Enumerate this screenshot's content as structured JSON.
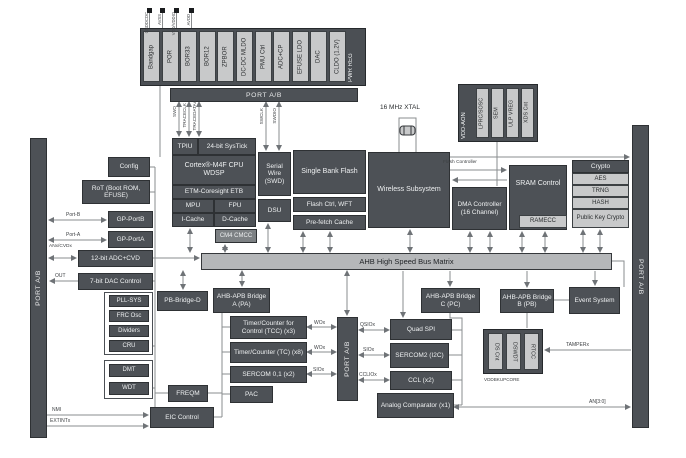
{
  "power": {
    "label": "PWR REG",
    "pins": [
      "GNDDCDC",
      "AVSS",
      "VDD/VDDIO",
      "AVDD"
    ],
    "cells": [
      "Bandgap",
      "POR",
      "BOR33",
      "BOR12",
      "ZPBOR",
      "DC-DC MLDO",
      "PMU Ctrl",
      "ADC+CP",
      "EFUSE LDO",
      "DAC",
      "CLDO (1.2V)"
    ]
  },
  "ports": {
    "top": "PORT A/B",
    "left": "PORT A/B",
    "mid": "PORT A/B",
    "right": "PORT A/B"
  },
  "cpu": {
    "tpiu": "TPIU",
    "systick": "24-bit SysTick",
    "core": "Cortex®-M4F CPU WDSP",
    "etb": "ETM-Coresight ETB",
    "mpu": "MPU",
    "fpu": "FPU",
    "icache": "I-Cache",
    "dcache": "D-Cache",
    "cmcc": "CM4 CMCC"
  },
  "debug": {
    "swd": "Serial Wire (SWD)",
    "dsu": "DSU"
  },
  "flash": {
    "bank": "Single Bank Flash",
    "ctrl": "Flash Ctrl, WFT",
    "prefetch": "Pre-fetch Cache",
    "controller_label": "Flash Controller"
  },
  "wireless": {
    "name": "Wireless Subsystem",
    "xtal_label": "16 MHz XTAL"
  },
  "aon": {
    "label": "VDD-AON",
    "cells": [
      "LPRC/SOSC",
      "SEM",
      "ULP VREG",
      "XDS Cnt"
    ]
  },
  "memory": {
    "dma": "DMA Controller (16 Channel)",
    "sram": "SRAM Control",
    "ramecc": "RAMECC"
  },
  "crypto": {
    "header": "Crypto",
    "cells": [
      "AES",
      "TRNG",
      "HASH",
      "Public Key Crypto"
    ]
  },
  "bus": {
    "label": "AHB High Speed Bus Matrix"
  },
  "left": {
    "config": "Config",
    "rot": "RoT (Boot ROM, EFUSE)",
    "gpb": "GP-PortB",
    "gpa": "GP-PortA",
    "adc": "12-bit ADC+CVD",
    "dac": "7-bit DAC Control",
    "clock_cells": [
      "PLL-SYS",
      "FRC Osc",
      "Dividers",
      "CRU"
    ],
    "watchdog_cells": [
      "DMT",
      "WDT"
    ]
  },
  "bridges": {
    "pbd": "PB-Bridge-D",
    "pa": "AHB-APB Bridge A (PA)",
    "pc": "AHB-APB Bridge C (PC)",
    "pb": "AHB-APB Bridge B (PB)"
  },
  "apb": {
    "tcc": "Timer/Counter for Control (TCC) (x3)",
    "tc": "Timer/Counter (TC) (x8)",
    "sercom01": "SERCOM 0,1 (x2)",
    "pac": "PAC",
    "freqm": "FREQM",
    "eic": "EIC Control"
  },
  "peripherals": {
    "qspi": "Quad SPI",
    "sercom2": "SERCOM2 (I2C)",
    "ccl": "CCL (x2)",
    "ac": "Analog Comparator (x1)",
    "event": "Event System"
  },
  "backup": {
    "cells": [
      "DS Cnt",
      "DSWDT",
      "RTCC"
    ],
    "label": "VDDBKUPCORE"
  },
  "signals": {
    "portb": "Port-B",
    "porta": "Port-A",
    "an": "ANx/CVDx",
    "out": "OUT",
    "nmi": "NMI",
    "extint": "EXTINTx",
    "swo": "SWO",
    "traceclk": "TRACECLK",
    "tracedata": "TRACEDATAx",
    "swclk": "SWCLK",
    "swdio": "SWDIO",
    "wox1": "WOx",
    "wox2": "WOx",
    "siox1": "SIOx",
    "qsiox": "QSIOx",
    "siox2": "SIOx",
    "ccliox": "CCLIOx",
    "tamper": "TAMPERx",
    "an30": "AN[3:0]"
  },
  "colors": {
    "dark": "#4d5156",
    "light": "#c8c9ca",
    "bus": "#b5b7b9",
    "line": "#8a8d8f"
  }
}
